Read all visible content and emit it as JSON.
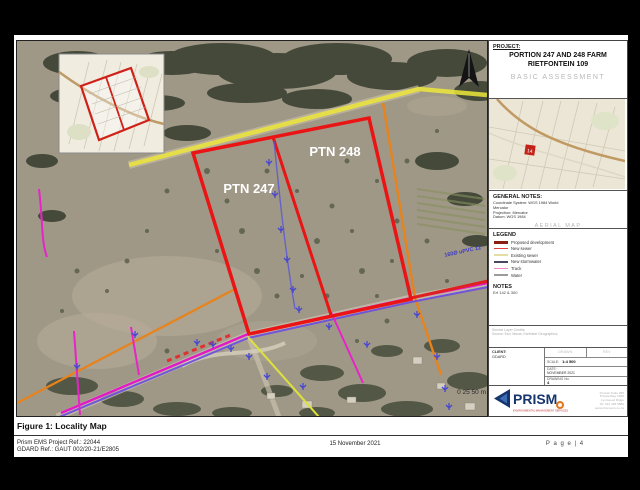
{
  "figure": {
    "caption": "Figure 1: Locality Map",
    "ref_line1": "Prism EMS Project Ref.: 22044",
    "ref_line2": "GDARD Ref.:  GAUT 002/20-21/E2805",
    "date": "15 November 2021",
    "page": "P a g e  | 4"
  },
  "map": {
    "ptn247_label": "PTN 247",
    "ptn248_label": "PTN 248",
    "pipe_label": "160Ø uPVC 12",
    "scale_text": "0  25 50 m"
  },
  "panel": {
    "project_heading": "PROJECT:",
    "project_title1": "PORTION 247 AND 248 FARM",
    "project_title2": "RIETFONTEIN 109",
    "assessment": "BASIC ASSESSMENT",
    "inset_marker": "14",
    "general_notes_heading": "GENERAL NOTES:",
    "gn_line1": "Coordinate System: WGS 1984 World",
    "gn_line2": "Mercator",
    "gn_line3": "Projection: Mercator",
    "gn_line4": "Datum: WGS 1984",
    "map_type": "AERIAL MAP",
    "legend_heading": "LEGEND",
    "legend_items": [
      {
        "label": "Proposed development",
        "color": "#8c1d12"
      },
      {
        "label": "New sewer",
        "color": "#e04040"
      },
      {
        "label": "Existing sewer",
        "color": "#e3dda6"
      },
      {
        "label": "New stormwater",
        "color": "#474760"
      },
      {
        "label": "Track",
        "color": "#ef86c8"
      },
      {
        "label": "Water",
        "color": "#9c9c9c"
      }
    ],
    "notes_heading": "NOTES",
    "notes_line": "Erf 142 & 300",
    "credits_line1": "Service Layer Credits:",
    "credits_line2": "Source: Esri, Maxar, Earthstar Geographics",
    "client_label": "CLIENT:",
    "client_value": "GDARD",
    "cell_drawn": "DRAWN",
    "cell_rev": "REV",
    "scale_label": "SCALE:",
    "scale_value": "1:4 500",
    "date_label": "DATE:",
    "date_value": "NOVEMBER 2021",
    "drawing_label": "DRAWING No:",
    "drawing_value": "4",
    "logo_text": "PRISM",
    "logo_tagline": "ENVIRONMENTAL MANAGEMENT SERVICES",
    "contact_lines": [
      "Postnet Suite 205",
      "Private Bag X025",
      "Lynnwood Ridge",
      "Tel: 012 348 5880",
      "www.prismems.co.za"
    ]
  }
}
